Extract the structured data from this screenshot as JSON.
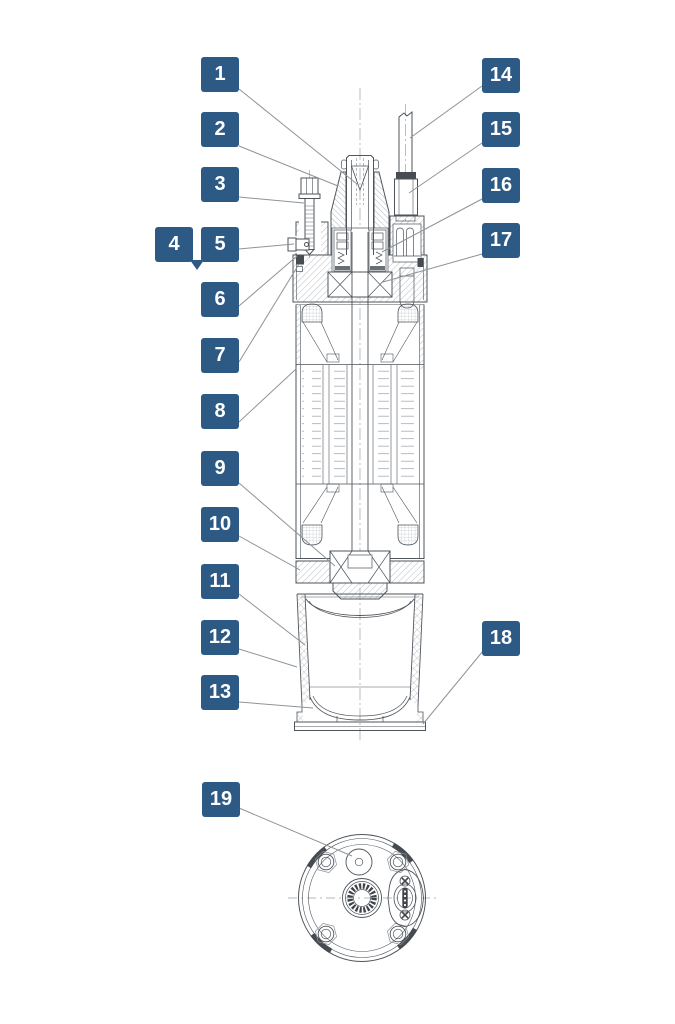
{
  "diagram_title": "",
  "colors": {
    "callout_bg": "#2d5a85",
    "callout_text": "#ffffff",
    "line": "#4e545a",
    "leader": "#8f9497"
  },
  "callouts": [
    {
      "id": 1,
      "label": "1"
    },
    {
      "id": 2,
      "label": "2"
    },
    {
      "id": 3,
      "label": "3"
    },
    {
      "id": 4,
      "label": "4"
    },
    {
      "id": 5,
      "label": "5"
    },
    {
      "id": 6,
      "label": "6"
    },
    {
      "id": 7,
      "label": "7"
    },
    {
      "id": 8,
      "label": "8"
    },
    {
      "id": 9,
      "label": "9"
    },
    {
      "id": 10,
      "label": "10"
    },
    {
      "id": 11,
      "label": "11"
    },
    {
      "id": 12,
      "label": "12"
    },
    {
      "id": 13,
      "label": "13"
    },
    {
      "id": 14,
      "label": "14"
    },
    {
      "id": 15,
      "label": "15"
    },
    {
      "id": 16,
      "label": "16"
    },
    {
      "id": 17,
      "label": "17"
    },
    {
      "id": 18,
      "label": "18"
    },
    {
      "id": 19,
      "label": "19"
    }
  ]
}
